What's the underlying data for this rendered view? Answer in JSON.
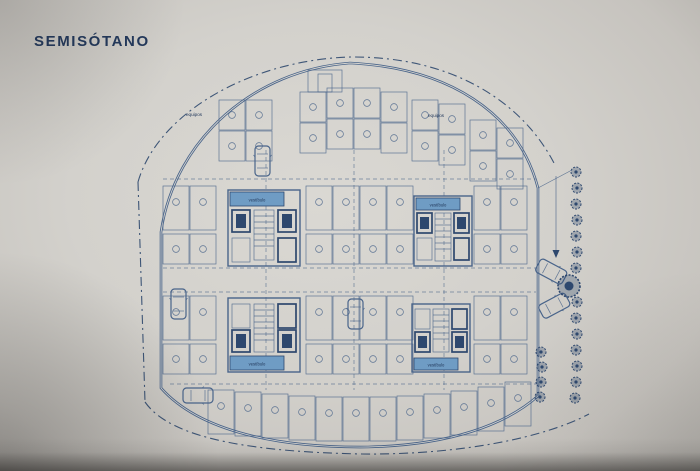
{
  "title": "SEMISÓTANO",
  "plan": {
    "labels": {
      "equipos_left": "equipos",
      "equipos_right": "equipos",
      "core_tl": "vestíbulo",
      "core_tr": "vestíbulo",
      "core_bl": "vestíbulo",
      "core_br": "vestíbulo"
    }
  },
  "colors": {
    "title": "#23395c",
    "ink": "#49648a",
    "ink_dark": "#2e486e",
    "core_band": "#6f9cc4",
    "paper": "#d6d4cf",
    "background": "#b4b1ac"
  }
}
